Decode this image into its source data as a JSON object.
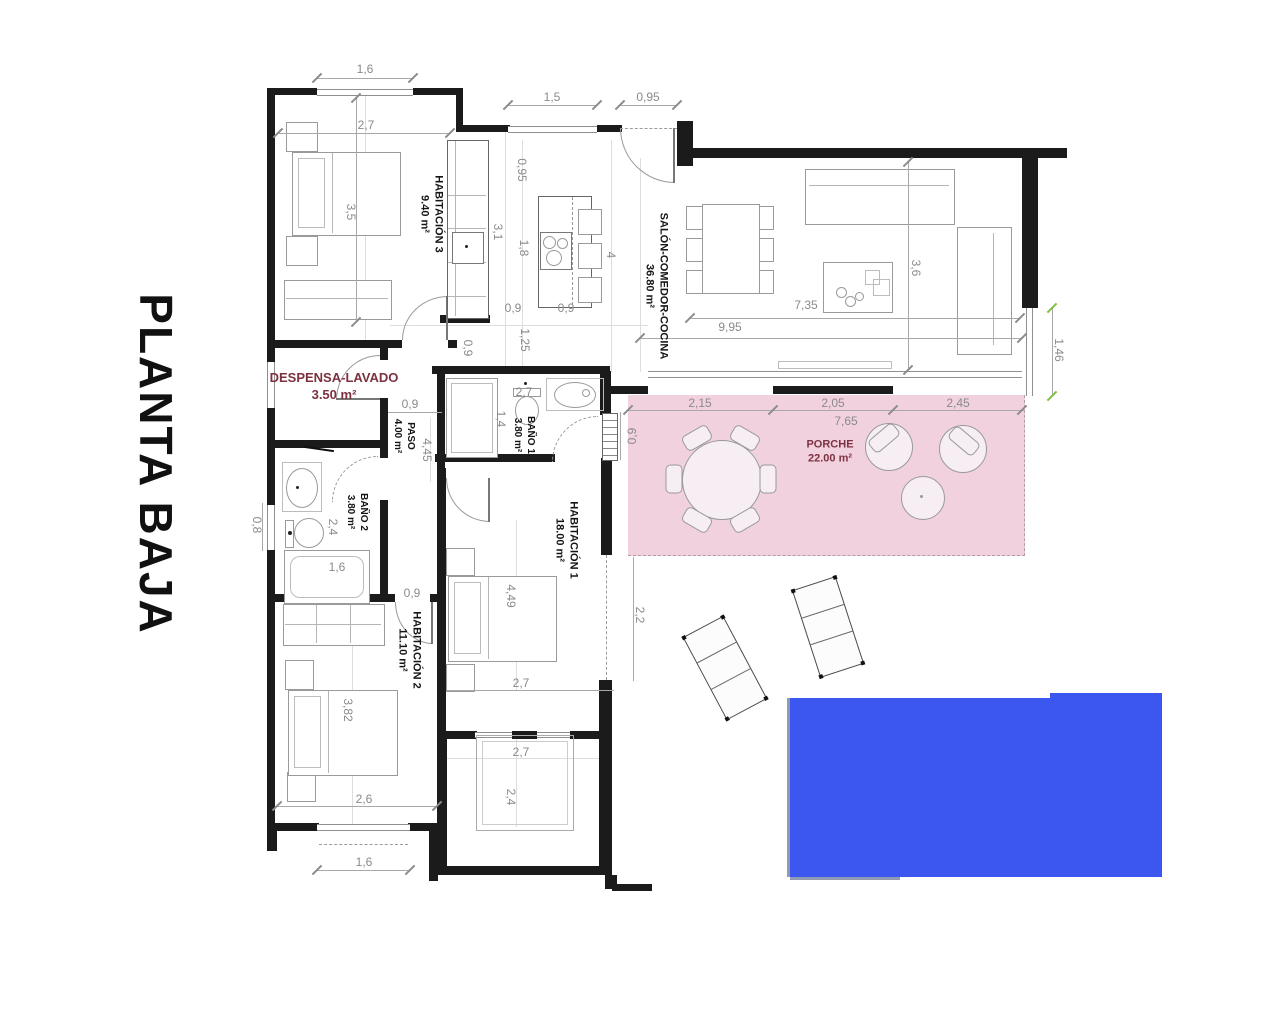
{
  "title": "PLANTA BAJA",
  "rooms": {
    "hab3": {
      "name": "HABITACIÓN 3",
      "area": "9.40 m²"
    },
    "salon": {
      "name": "SALÓN-COMEDOR-COCINA",
      "area": "36.80 m²"
    },
    "despensa": {
      "name": "DESPENSA-LAVADO",
      "area": "3.50 m²"
    },
    "paso": {
      "name": "PASO",
      "area": "4.00 m²"
    },
    "bano1": {
      "name": "BAÑO 1",
      "area": "3.80 m²"
    },
    "bano2": {
      "name": "BAÑO 2",
      "area": "3.80 m²"
    },
    "hab1": {
      "name": "HABITACIÓN 1",
      "area": "18.00 m²"
    },
    "hab2": {
      "name": "HABITACIÓN 2",
      "area": "11.10 m²"
    },
    "porche": {
      "name": "PORCHE",
      "area": "22.00 m²"
    }
  },
  "dims": [
    "1,6",
    "2,7",
    "3,5",
    "1,5",
    "0,95",
    "0,95",
    "3,1",
    "1,8",
    "4",
    "0,9",
    "0,9",
    "0,9",
    "1,25",
    "3,6",
    "7,35",
    "9,95",
    "1,46",
    "0,9",
    "4,45",
    "2,7",
    "1,4",
    "0,9",
    "2,15",
    "2,05",
    "2,45",
    "7,65",
    "0,8",
    "2,4",
    "1,6",
    "0,9",
    "4,49",
    "2,2",
    "3,82",
    "2,7",
    "2,6",
    "1,6",
    "2,7",
    "2,4"
  ],
  "colors": {
    "pool": "#3b57ef",
    "porch": "#f2d1df",
    "accent_text": "#7d3140",
    "dimension_text": "#8a8a8a",
    "wall": "#1b1b1b",
    "green_tick": "#7cc142"
  }
}
